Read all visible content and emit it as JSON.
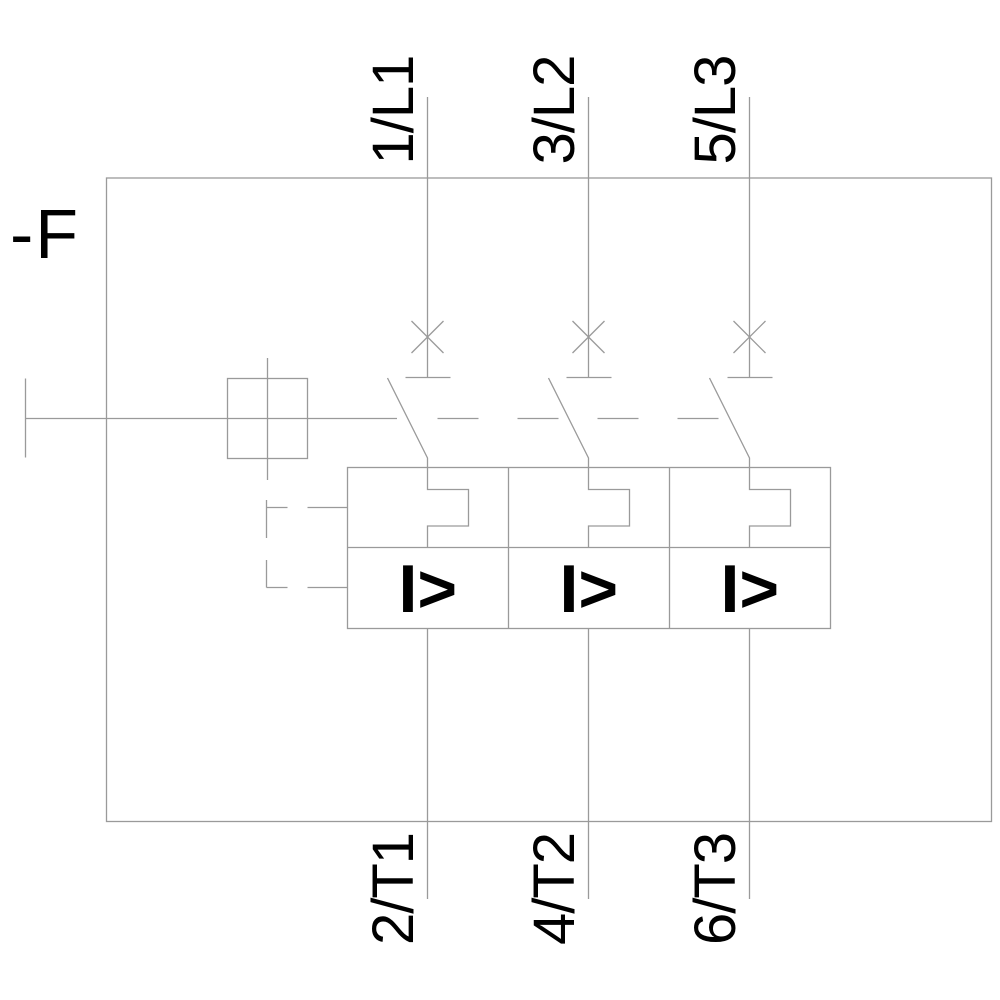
{
  "diagram": {
    "component_label": "-F",
    "top_terminals": [
      {
        "label": "1/L1"
      },
      {
        "label": "3/L2"
      },
      {
        "label": "5/L3"
      }
    ],
    "bottom_terminals": [
      {
        "label": "2/T1"
      },
      {
        "label": "4/T2"
      },
      {
        "label": "6/T3"
      }
    ],
    "overcurrent_symbol": "I>",
    "colors": {
      "line": "#9a9a9a",
      "text": "#000000",
      "background": "#ffffff"
    }
  }
}
